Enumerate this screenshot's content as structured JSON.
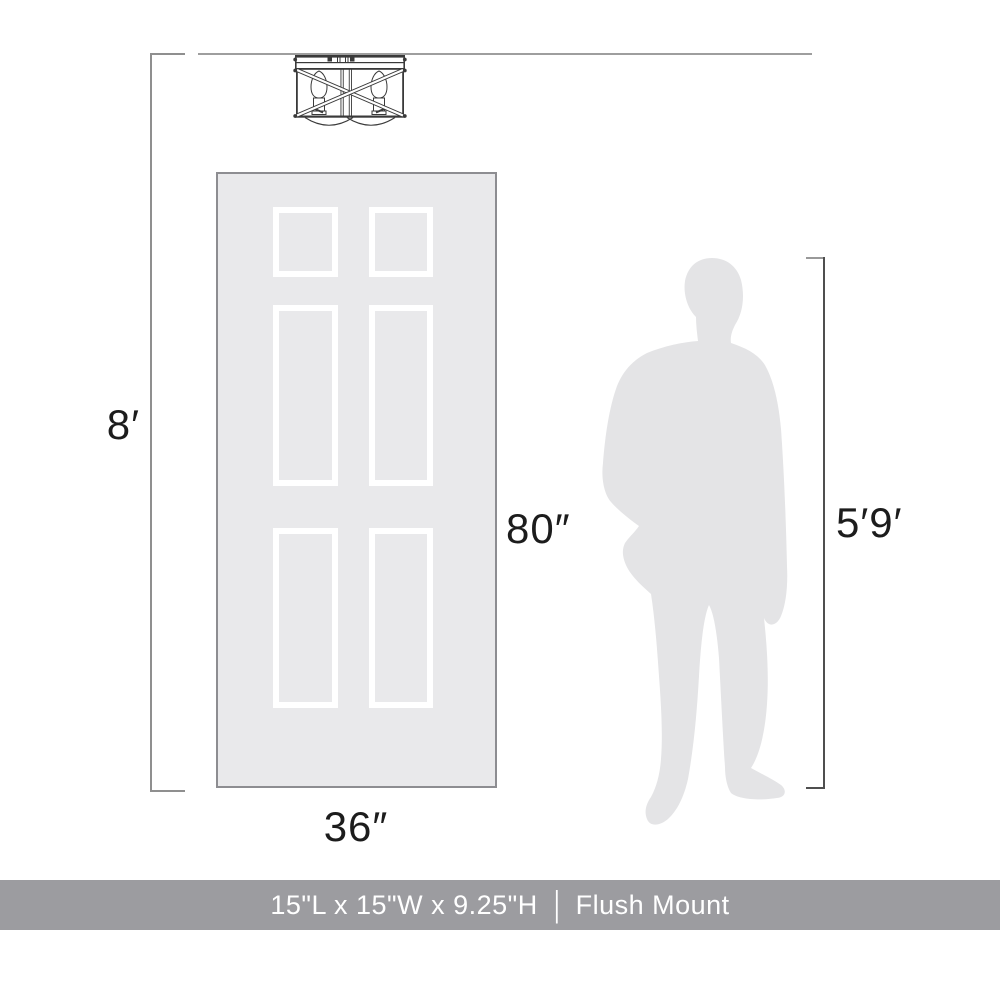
{
  "labels": {
    "ceiling_height": "8′",
    "door_height": "80″",
    "door_width": "36″",
    "person_height": "5′9′"
  },
  "footer": {
    "dimensions_text": "15\"L x 15\"W x 9.25\"H",
    "separator": "|",
    "mount_type": "Flush Mount"
  },
  "colors": {
    "line_light": "#9e9e9e",
    "line_mid": "#8f8f8f",
    "line_dark": "#4f4f4f",
    "label": "#1c1c1c",
    "door_fill": "#e9e9eb",
    "door_border": "#8d8d91",
    "panel_white": "#ffffff",
    "person_fill": "#e4e4e6",
    "fixture_stroke": "#3a3a3a",
    "footer_bg": "#9c9ca0",
    "footer_text": "#ffffff"
  }
}
